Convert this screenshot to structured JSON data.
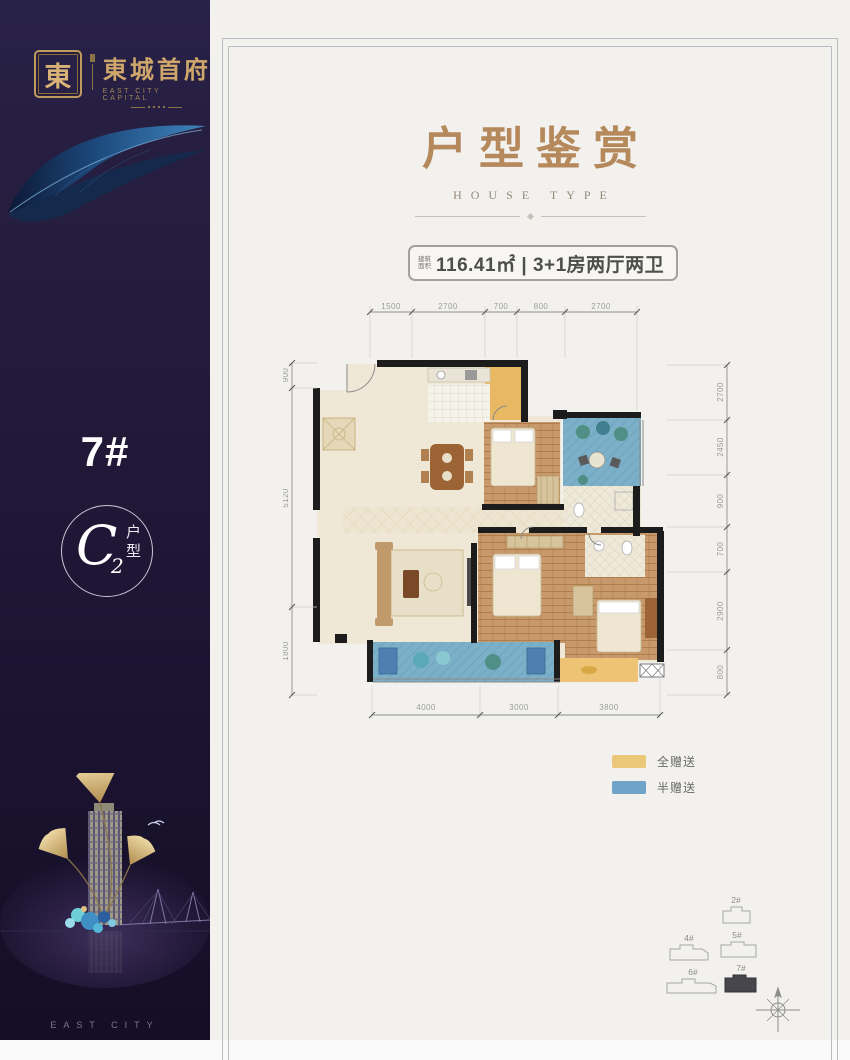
{
  "sidebar": {
    "seal_char": "東",
    "brand_cn": "東城首府",
    "brand_en": "EAST CITY CAPITAL",
    "building_no": "7#",
    "unit_letter": "C",
    "unit_sub": "2",
    "unit_label_top": "户",
    "unit_label_bottom": "型",
    "footer": "EAST CITY",
    "bg_color": "#241c3a",
    "gold_color": "#cfa76a"
  },
  "page": {
    "title": "户型鉴赏",
    "subtitle": "HOUSE TYPE",
    "title_color": "#b5895c",
    "badge": {
      "prefix_line1": "建筑",
      "prefix_line2": "面积",
      "text": "116.41㎡ | 3+1房两厅两卫"
    },
    "legend": {
      "items": [
        {
          "label": "全赠送",
          "color": "#eac878"
        },
        {
          "label": "半赠送",
          "color": "#6fa3c8"
        }
      ]
    },
    "floorplan": {
      "dims": {
        "top": [
          "1500",
          "2700",
          "700",
          "800",
          "2700"
        ],
        "bottom": [
          "4000",
          "3000",
          "3800"
        ],
        "left": [
          "900",
          "5120",
          "1800"
        ],
        "right": [
          "2700",
          "2450",
          "900",
          "700",
          "2900",
          "800"
        ]
      }
    },
    "siteplan": {
      "buildings": [
        {
          "id": "2#",
          "highlighted": false
        },
        {
          "id": "4#",
          "highlighted": false
        },
        {
          "id": "5#",
          "highlighted": false
        },
        {
          "id": "6#",
          "highlighted": false
        },
        {
          "id": "7#",
          "highlighted": true
        }
      ]
    }
  }
}
